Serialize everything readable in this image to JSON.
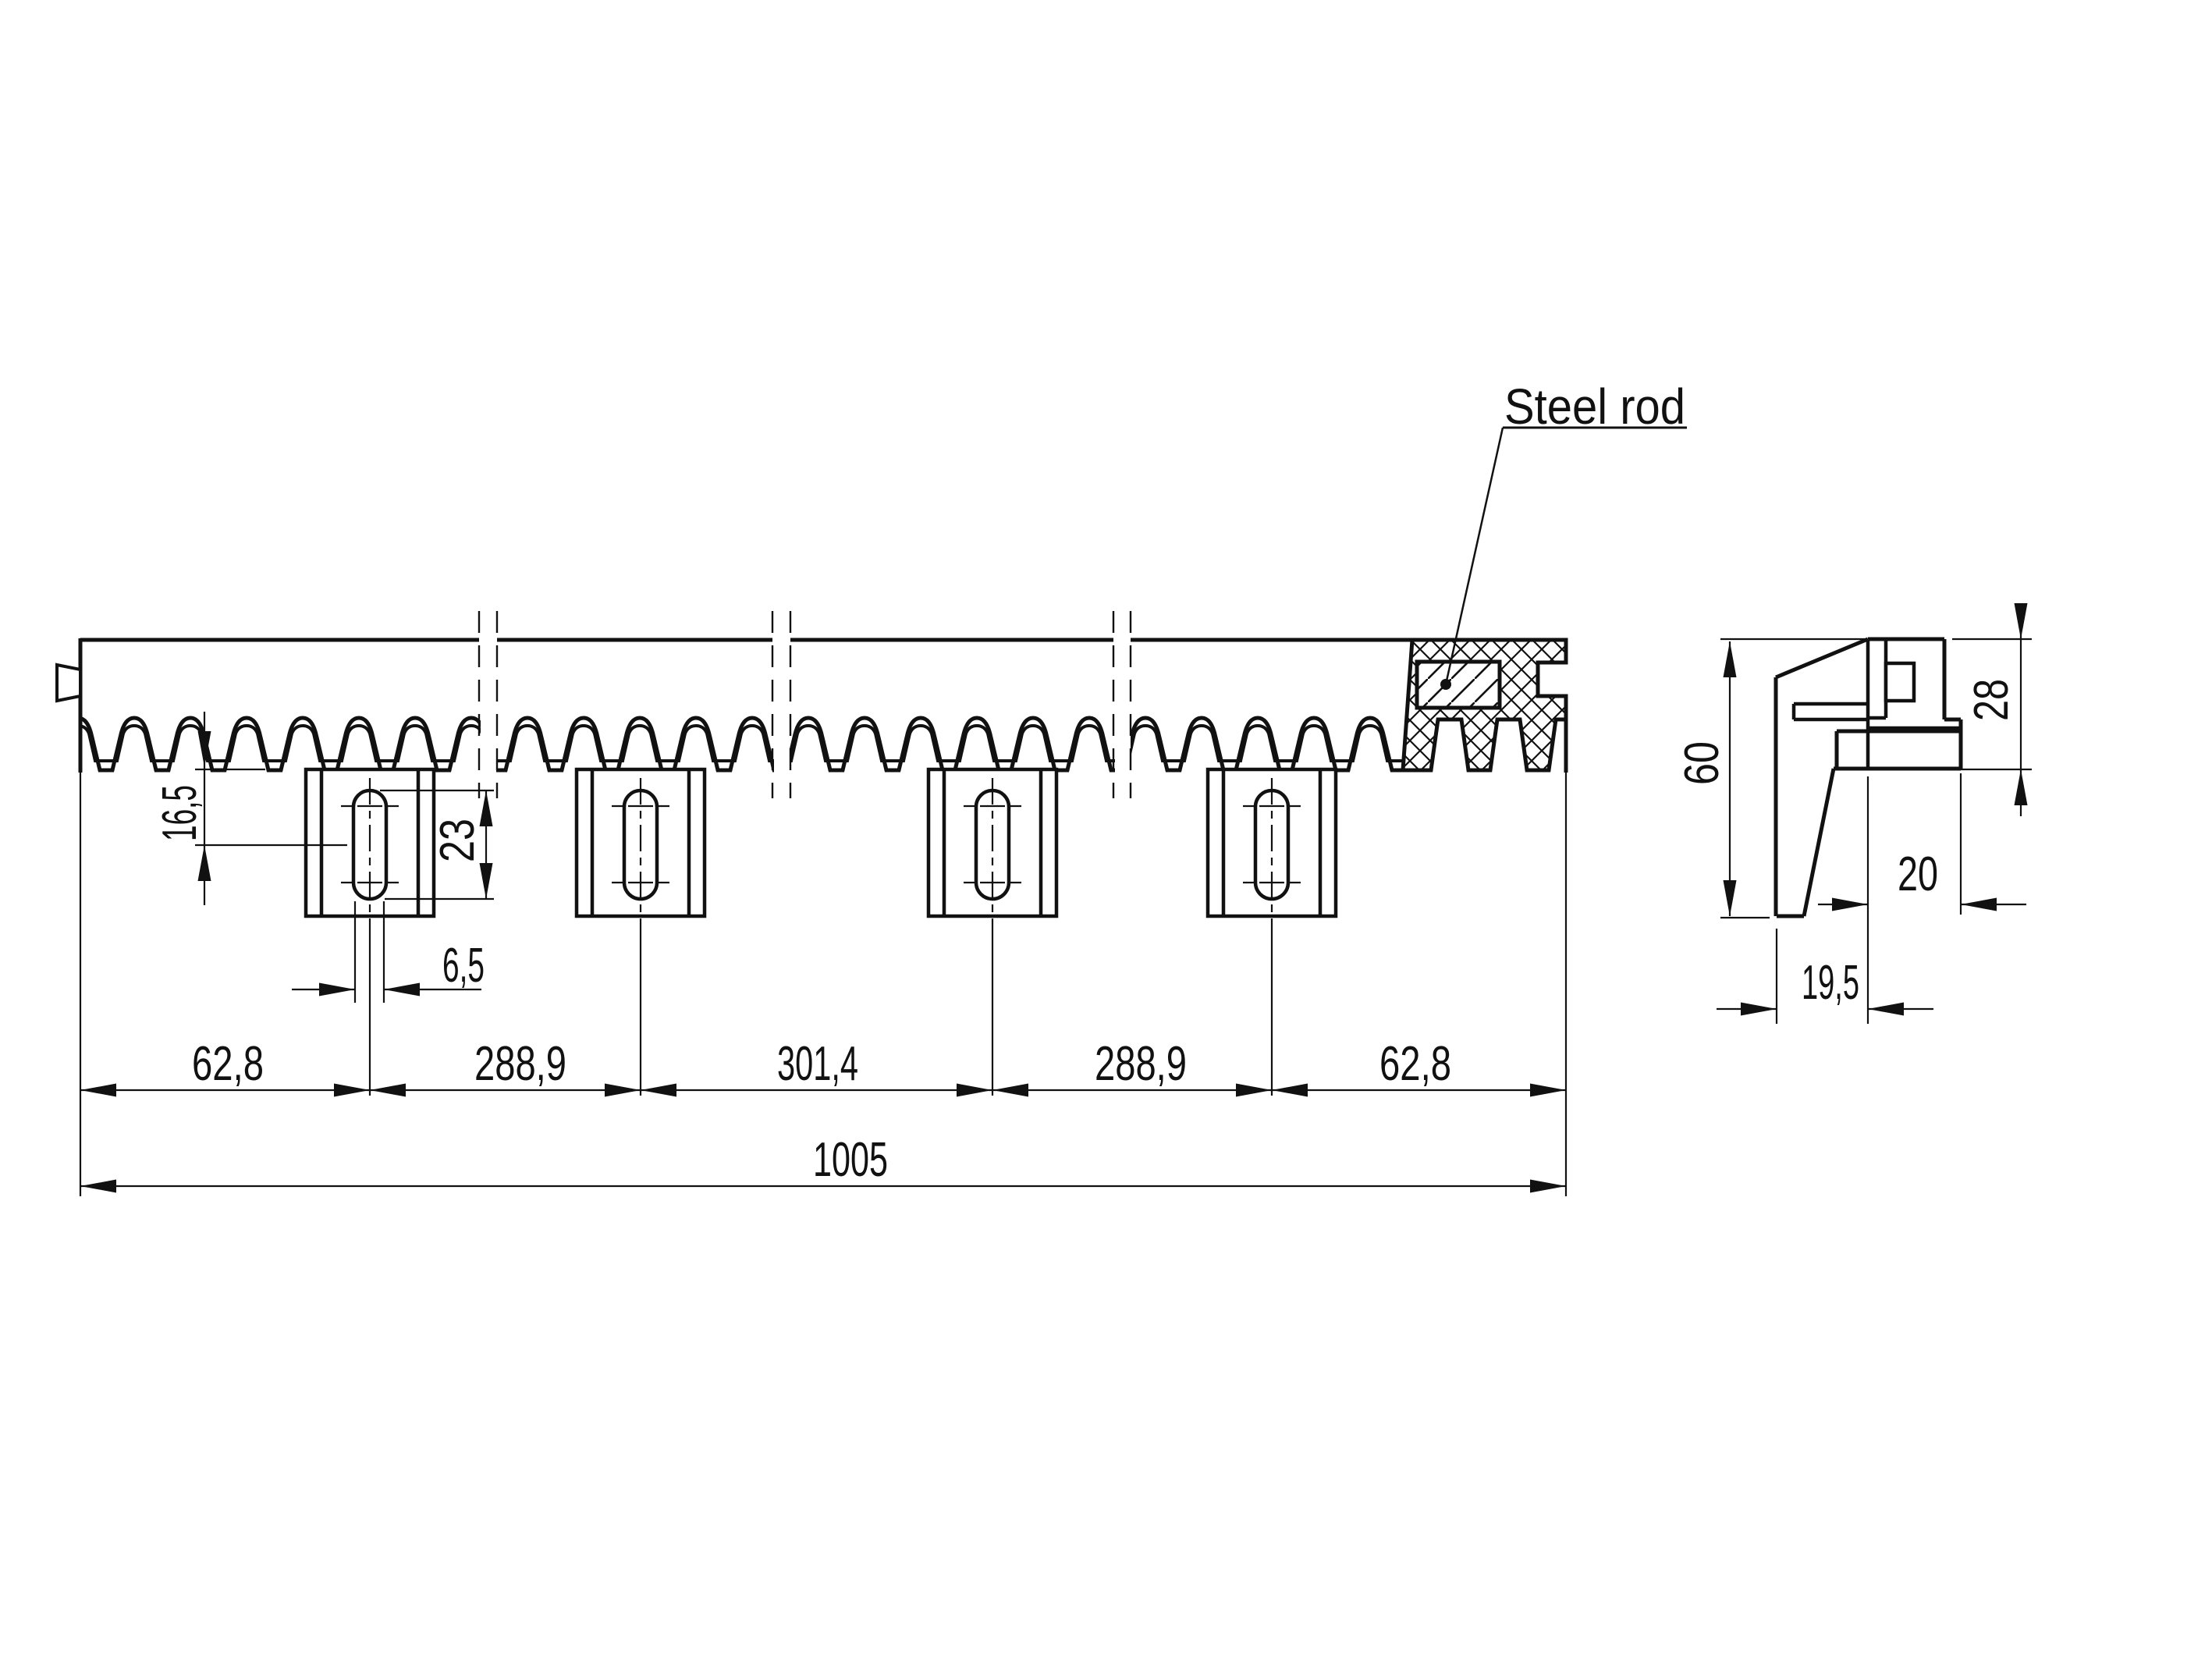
{
  "drawing": {
    "labels": {
      "steel_rod": "Steel rod"
    },
    "main_view": {
      "dim_tooth_to_slot_center": "16,5",
      "dim_slot_length": "23",
      "dim_slot_width": "6,5",
      "dim_row": [
        "62,8",
        "288,9",
        "301,4",
        "288,9",
        "62,8"
      ],
      "dim_total": "1005"
    },
    "side_view": {
      "dim_height": "60",
      "dim_depth_top": "28",
      "dim_base_width": "20",
      "dim_foot_width": "19,5"
    },
    "colors": {
      "ink": "#111111",
      "background": "#ffffff"
    }
  }
}
